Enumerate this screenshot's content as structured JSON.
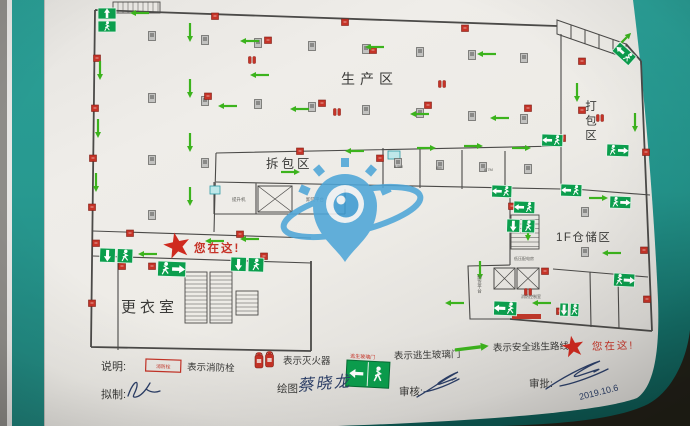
{
  "areas": {
    "production": "生产区",
    "packing": "打包区",
    "unpacking": "拆包区",
    "storage_1f": "1F仓储区",
    "changing_room": "更衣室",
    "you_are_here": "您在这!"
  },
  "small_labels": [
    {
      "text": "提升机",
      "x": 232,
      "y": 201,
      "size": 4.5,
      "v": false
    },
    {
      "text": "卸货平台",
      "x": 306,
      "y": 201,
      "size": 4.5,
      "v": false
    },
    {
      "text": "卸货平台",
      "x": 480,
      "y": 275,
      "size": 4.5,
      "v": true
    },
    {
      "text": "低压配电房",
      "x": 514,
      "y": 260,
      "size": 4,
      "v": false
    },
    {
      "text": "消防控制室",
      "x": 521,
      "y": 298,
      "size": 4,
      "v": false
    },
    {
      "text": "8.5M",
      "x": 394,
      "y": 168,
      "size": 4,
      "v": false
    },
    {
      "text": "8M",
      "x": 436,
      "y": 169,
      "size": 4,
      "v": false
    },
    {
      "text": "8.7M",
      "x": 484,
      "y": 171,
      "size": 4,
      "v": false
    }
  ],
  "legend": {
    "heading": "说明:",
    "items": [
      {
        "label": "表示消防栓",
        "symbol_text": "消防栓"
      },
      {
        "label": "表示灭火器"
      },
      {
        "label": "表示逃生玻璃门",
        "symbol_caption": "逃生玻璃门"
      },
      {
        "label": "表示安全逃生路线"
      },
      {
        "label": "您在这!"
      }
    ]
  },
  "signoff": {
    "drafted_label": "拟制:",
    "drawn_label": "绘图:",
    "drawn_name": "蔡晓龙",
    "reviewed_label": "审核:",
    "approved_label": "审批:",
    "approved_date": "2019.10.6"
  },
  "colors": {
    "exit_green": "#0b9e4d",
    "route_green": "#3cb31d",
    "alarm_red": "#c63327",
    "ink": "#2c3f68",
    "wall_teal": "#2a9c93",
    "wall_line": "#4b4a48"
  },
  "map_symbols": {
    "arrows": [
      [
        140,
        13,
        180
      ],
      [
        250,
        41,
        180
      ],
      [
        375,
        47,
        180
      ],
      [
        487,
        54,
        180
      ],
      [
        228,
        106,
        180
      ],
      [
        300,
        109,
        180
      ],
      [
        420,
        114,
        180
      ],
      [
        500,
        118,
        180
      ],
      [
        260,
        75,
        180
      ],
      [
        190,
        32,
        90
      ],
      [
        190,
        88,
        90
      ],
      [
        190,
        142,
        90
      ],
      [
        190,
        196,
        90
      ],
      [
        100,
        70,
        90
      ],
      [
        98,
        128,
        90
      ],
      [
        96,
        182,
        90
      ],
      [
        577,
        92,
        90
      ],
      [
        635,
        122,
        90
      ],
      [
        624,
        40,
        315
      ],
      [
        290,
        172,
        0
      ],
      [
        426,
        148,
        0
      ],
      [
        473,
        146,
        0
      ],
      [
        521,
        148,
        0
      ],
      [
        355,
        151,
        180
      ],
      [
        148,
        254,
        180
      ],
      [
        215,
        241,
        180
      ],
      [
        250,
        239,
        180
      ],
      [
        598,
        198,
        0
      ],
      [
        528,
        231,
        90
      ],
      [
        612,
        253,
        180
      ],
      [
        480,
        270,
        90
      ],
      [
        542,
        303,
        180
      ],
      [
        455,
        303,
        180
      ]
    ],
    "hydrants": [
      [
        97,
        58
      ],
      [
        95,
        108
      ],
      [
        93,
        158
      ],
      [
        92,
        207
      ],
      [
        96,
        243
      ],
      [
        122,
        266
      ],
      [
        92,
        303
      ],
      [
        215,
        16
      ],
      [
        345,
        22
      ],
      [
        465,
        28
      ],
      [
        268,
        40
      ],
      [
        208,
        96
      ],
      [
        322,
        103
      ],
      [
        373,
        50
      ],
      [
        428,
        105
      ],
      [
        528,
        108
      ],
      [
        582,
        61
      ],
      [
        582,
        110
      ],
      [
        562,
        138
      ],
      [
        646,
        152
      ],
      [
        380,
        158
      ],
      [
        300,
        151
      ],
      [
        512,
        206
      ],
      [
        545,
        271
      ],
      [
        560,
        311
      ],
      [
        644,
        250
      ],
      [
        647,
        299
      ],
      [
        240,
        234
      ],
      [
        130,
        233
      ],
      [
        152,
        266
      ],
      [
        264,
        256
      ]
    ],
    "extinguishers": [
      [
        252,
        60
      ],
      [
        442,
        84
      ],
      [
        600,
        118
      ],
      [
        528,
        292
      ],
      [
        337,
        112
      ]
    ],
    "pillars": [
      [
        152,
        36
      ],
      [
        205,
        40
      ],
      [
        258,
        43
      ],
      [
        312,
        46
      ],
      [
        366,
        49
      ],
      [
        420,
        52
      ],
      [
        472,
        55
      ],
      [
        524,
        58
      ],
      [
        152,
        98
      ],
      [
        205,
        101
      ],
      [
        258,
        104
      ],
      [
        312,
        107
      ],
      [
        366,
        110
      ],
      [
        420,
        113
      ],
      [
        472,
        116
      ],
      [
        524,
        119
      ],
      [
        152,
        160
      ],
      [
        205,
        163
      ],
      [
        152,
        215
      ],
      [
        398,
        163
      ],
      [
        440,
        165
      ],
      [
        483,
        167
      ],
      [
        528,
        169
      ],
      [
        585,
        212
      ],
      [
        585,
        252
      ]
    ],
    "exit_signs": [
      {
        "x": 98,
        "y": 8,
        "w": 18,
        "h": 24,
        "kind": "pv",
        "rot": 0
      },
      {
        "x": 620,
        "y": 42,
        "w": 22,
        "h": 12,
        "kind": "s",
        "rot": 42
      },
      {
        "x": 607,
        "y": 144,
        "w": 22,
        "h": 12,
        "kind": "sr",
        "rot": 2
      },
      {
        "x": 542,
        "y": 134,
        "w": 21,
        "h": 12,
        "kind": "s",
        "rot": 2
      },
      {
        "x": 561,
        "y": 184,
        "w": 21,
        "h": 12,
        "kind": "s",
        "rot": 2
      },
      {
        "x": 610,
        "y": 196,
        "w": 21,
        "h": 12,
        "kind": "sr",
        "rot": 2
      },
      {
        "x": 492,
        "y": 185,
        "w": 20,
        "h": 12,
        "kind": "s",
        "rot": 2
      },
      {
        "x": 514,
        "y": 201,
        "w": 21,
        "h": 12,
        "kind": "s",
        "rot": 2
      },
      {
        "x": 507,
        "y": 219,
        "w": 28,
        "h": 13,
        "kind": "ph",
        "rot": 2
      },
      {
        "x": 614,
        "y": 273,
        "w": 21,
        "h": 13,
        "kind": "sr",
        "rot": 3
      },
      {
        "x": 494,
        "y": 301,
        "w": 23,
        "h": 14,
        "kind": "s",
        "rot": 2
      },
      {
        "x": 560,
        "y": 303,
        "w": 19,
        "h": 13,
        "kind": "ph",
        "rot": 2
      },
      {
        "x": 100,
        "y": 248,
        "w": 33,
        "h": 14,
        "kind": "ph",
        "rot": 2
      },
      {
        "x": 158,
        "y": 261,
        "w": 28,
        "h": 15,
        "kind": "sr",
        "rot": 2
      },
      {
        "x": 231,
        "y": 257,
        "w": 33,
        "h": 14,
        "kind": "ph",
        "rot": 2
      }
    ],
    "accents": [
      {
        "t": "redbar",
        "x": 512,
        "y": 314,
        "w": 29,
        "h": 5
      },
      {
        "t": "cyan",
        "x": 388,
        "y": 151,
        "w": 12,
        "h": 8
      },
      {
        "t": "cyan",
        "x": 210,
        "y": 186,
        "w": 10,
        "h": 8
      }
    ]
  }
}
